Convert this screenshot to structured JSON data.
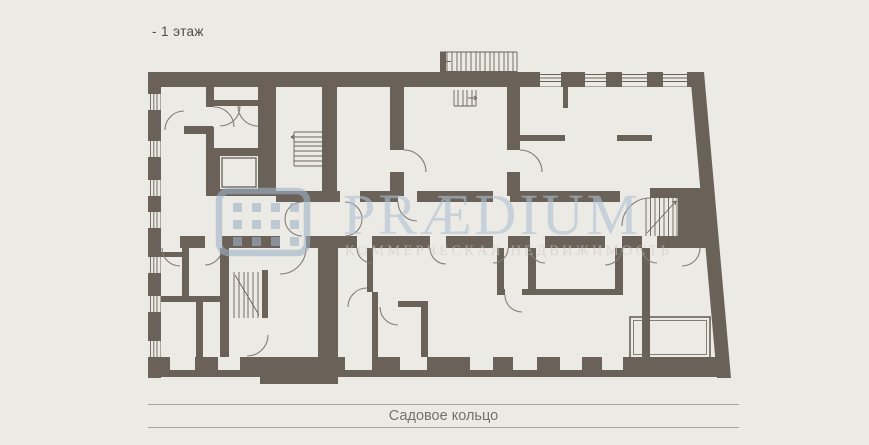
{
  "header": {
    "floor_label": "- 1 этаж"
  },
  "plan": {
    "street_label": "Садовое кольцо",
    "watermark": {
      "brand": "PRÆDIUM",
      "tagline": "КОММЕРЧЕСКАЯ НЕДВИЖИМОСТЬ",
      "logo_icon": "praedium-window-grid-logo",
      "brand_color": "#aec2d4",
      "tagline_color": "#cfc9c2"
    },
    "colors": {
      "wall": "#6A6159",
      "background": "#ECEAE5",
      "detail_line": "#847d75",
      "road_line": "#a8a7a0"
    }
  }
}
